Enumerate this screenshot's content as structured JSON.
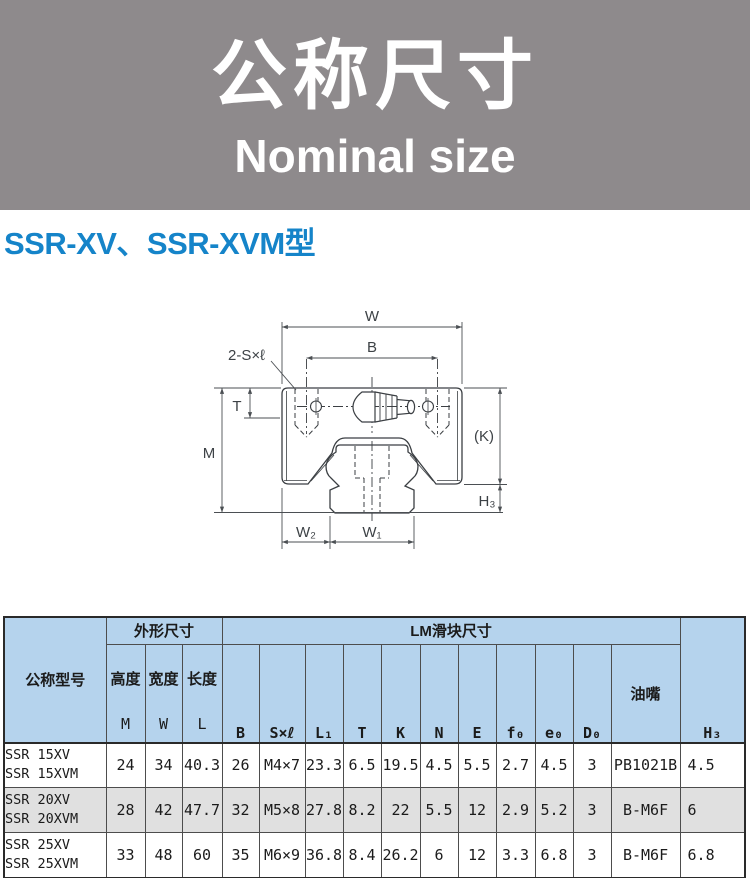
{
  "banner": {
    "title_zh": "公称尺寸",
    "title_en": "Nominal size"
  },
  "section": {
    "title": "SSR-XV、SSR-XVM型"
  },
  "colors": {
    "banner_bg": "#8e8a8c",
    "section_title_blue": "#1584c9",
    "table_header_bg": "#b5d3ed",
    "table_alt_row_bg": "#e0e0e0",
    "drawing_line": "#3b3f43"
  },
  "diagram": {
    "labels": {
      "w": "W",
      "b": "B",
      "screw": "2-S×ℓ",
      "t": "T",
      "m": "M",
      "k": "(K)",
      "h3": "H₃",
      "w2": "W₂",
      "w1": "W₁"
    }
  },
  "table": {
    "col_model": "公称型号",
    "group_outer": "外形尺寸",
    "group_block": "LM滑块尺寸",
    "col_h3": "H₃",
    "col_nipple": "油嘴",
    "sub": [
      {
        "zh": "高度",
        "sym": "M"
      },
      {
        "zh": "宽度",
        "sym": "W"
      },
      {
        "zh": "长度",
        "sym": "L"
      }
    ],
    "dims": [
      "B",
      "S×ℓ",
      "L₁",
      "T",
      "K",
      "N",
      "E",
      "f₀",
      "e₀",
      "D₀"
    ],
    "rows": [
      {
        "model1": "SSR 15XV",
        "model2": "SSR 15XVM",
        "values": [
          "24",
          "34",
          "40.3",
          "26",
          "M4×7",
          "23.3",
          "6.5",
          "19.5",
          "4.5",
          "5.5",
          "2.7",
          "4.5",
          "3",
          "PB1021B",
          "4.5"
        ]
      },
      {
        "model1": "SSR 20XV",
        "model2": "SSR 20XVM",
        "values": [
          "28",
          "42",
          "47.7",
          "32",
          "M5×8",
          "27.8",
          "8.2",
          "22",
          "5.5",
          "12",
          "2.9",
          "5.2",
          "3",
          "B-M6F",
          "6"
        ]
      },
      {
        "model1": "SSR 25XV",
        "model2": "SSR 25XVM",
        "values": [
          "33",
          "48",
          "60",
          "35",
          "M6×9",
          "36.8",
          "8.4",
          "26.2",
          "6",
          "12",
          "3.3",
          "6.8",
          "3",
          "B-M6F",
          "6.8"
        ]
      }
    ]
  }
}
